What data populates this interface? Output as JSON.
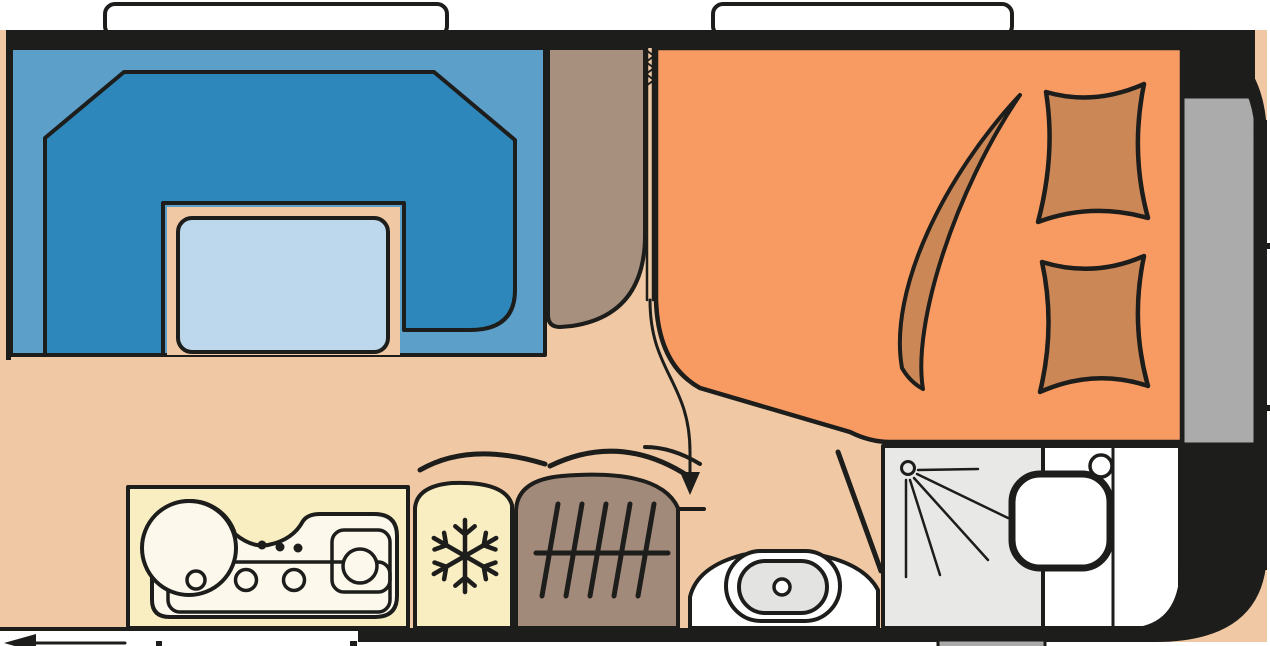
{
  "plan": {
    "kind": "caravan-floorplan",
    "orientation": "front-right",
    "fixtures": [
      "rear-window",
      "front-window",
      "u-shaped-dinette",
      "dinette-table",
      "wardrobe",
      "concertina-partition-door",
      "double-bed",
      "blanket",
      "pillow",
      "pillow",
      "front-storage-shelf",
      "kitchen-counter",
      "sink-and-hob",
      "fridge",
      "heater",
      "toilet",
      "bathroom-door",
      "shower",
      "washbasin",
      "faucet",
      "entrance-door",
      "service-hatch",
      "drawbar-stub"
    ],
    "icons": [
      "snowflake-icon",
      "heater-grille-icon",
      "shower-spray-icon",
      "door-swing-arrow-icon",
      "concertina-door-icon",
      "entry-arrow-icon"
    ]
  },
  "colors": {
    "wall": "#1d1d1b",
    "floor": "#f0c9a4",
    "dinette_base": "#5c9fc9",
    "dinette_seat": "#2e87ba",
    "table": "#bdd8ec",
    "window": "#ffffff",
    "bed": "#f89b63",
    "bedding": "#cc8757",
    "furniture": "#a8907f",
    "heater": "#a28a7a",
    "kitchen": "#f9edc2",
    "sink": "#fcf9ec",
    "shower": "#e8e8e7",
    "bathroom": "#ffffff",
    "toilet": "#e3e3e2",
    "front_storage": "#ababab",
    "step": "#a9a9a9"
  }
}
